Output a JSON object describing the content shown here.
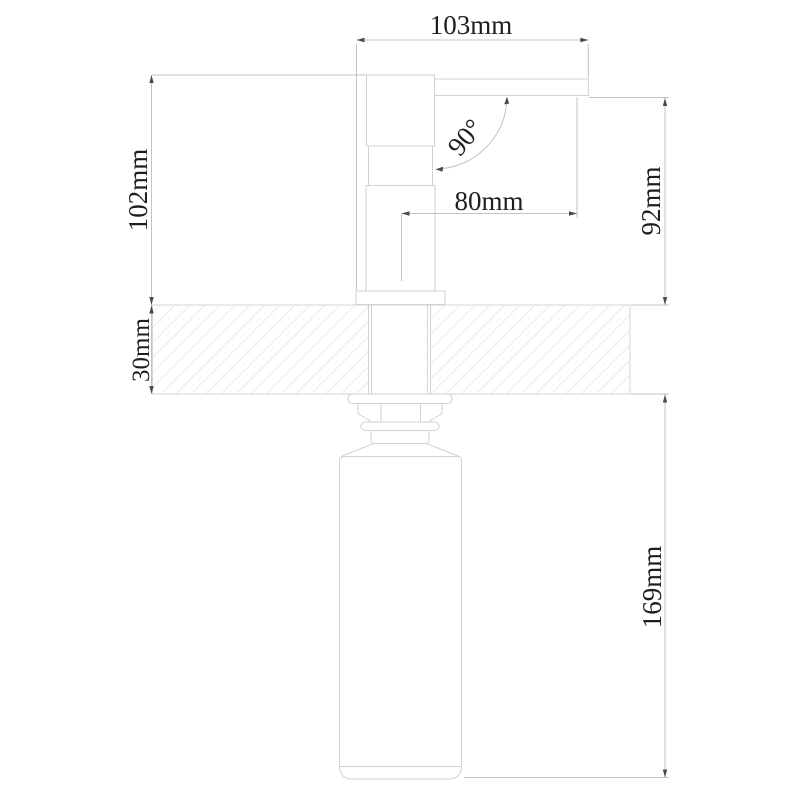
{
  "drawing": {
    "dimensions": {
      "spout_span": "103mm",
      "body_height": "102mm",
      "spout_angle": "90°",
      "spout_reach": "80mm",
      "clearance_height": "92mm",
      "deck_thickness": "30mm",
      "under_counter_length": "169mm"
    },
    "colors": {
      "background": "#ffffff",
      "outline": "#d2d2d2",
      "dimension_line": "#c3c3c3",
      "arrow": "#4a4a4a",
      "text": "#1e1e1e",
      "hatch": "#eaeaea"
    }
  }
}
